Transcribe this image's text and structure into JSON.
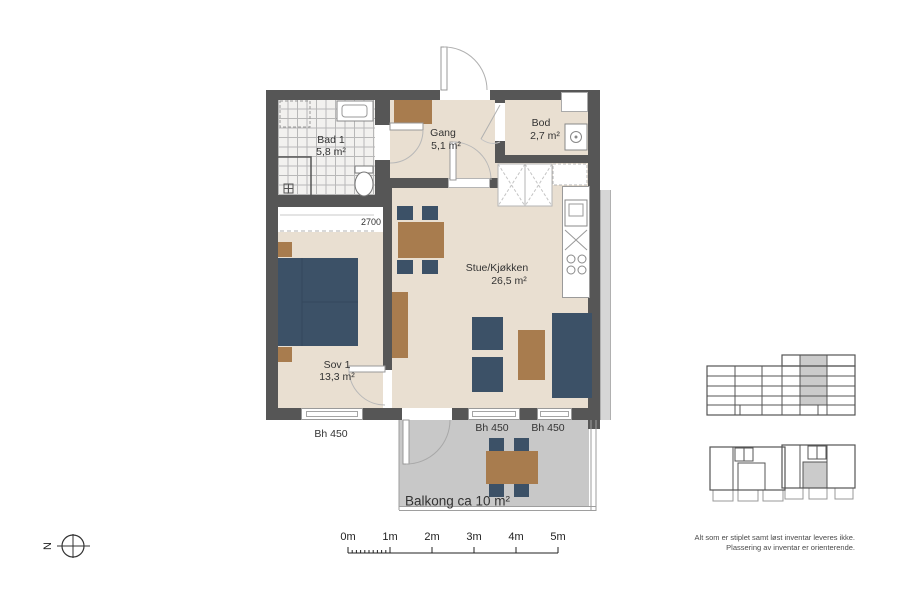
{
  "rooms": {
    "bad1": {
      "name": "Bad 1",
      "area": "5,8 m²"
    },
    "gang": {
      "name": "Gang",
      "area": "5,1 m²"
    },
    "bod": {
      "name": "Bod",
      "area": "2,7 m²"
    },
    "stue": {
      "name": "Stue/Kjøkken",
      "area": "26,5 m²"
    },
    "sov1": {
      "name": "Sov 1",
      "area": "13,3 m²"
    },
    "balcony": {
      "label": "Balkong ca 10 m²"
    }
  },
  "labels": {
    "window_height": [
      "Bh 450",
      "Bh 450",
      "Bh 450"
    ],
    "wardrobe_width": "2700"
  },
  "scalebar": {
    "ticks": [
      "0m",
      "1m",
      "2m",
      "3m",
      "4m",
      "5m"
    ]
  },
  "compass": {
    "north": "N"
  },
  "notes": [
    "Alt som er stiplet samt løst inventar leveres ikke.",
    "Plassering av inventar er orienterende."
  ],
  "colors": {
    "wall": "#565656",
    "floor": "#e9dfd1",
    "tile_line": "#b8b8b8",
    "furniture_blue": "#3c5167",
    "furniture_wood": "#a87c4e",
    "balcony_floor": "#c8c8c8",
    "overview_highlight": "#cbcbcb"
  }
}
